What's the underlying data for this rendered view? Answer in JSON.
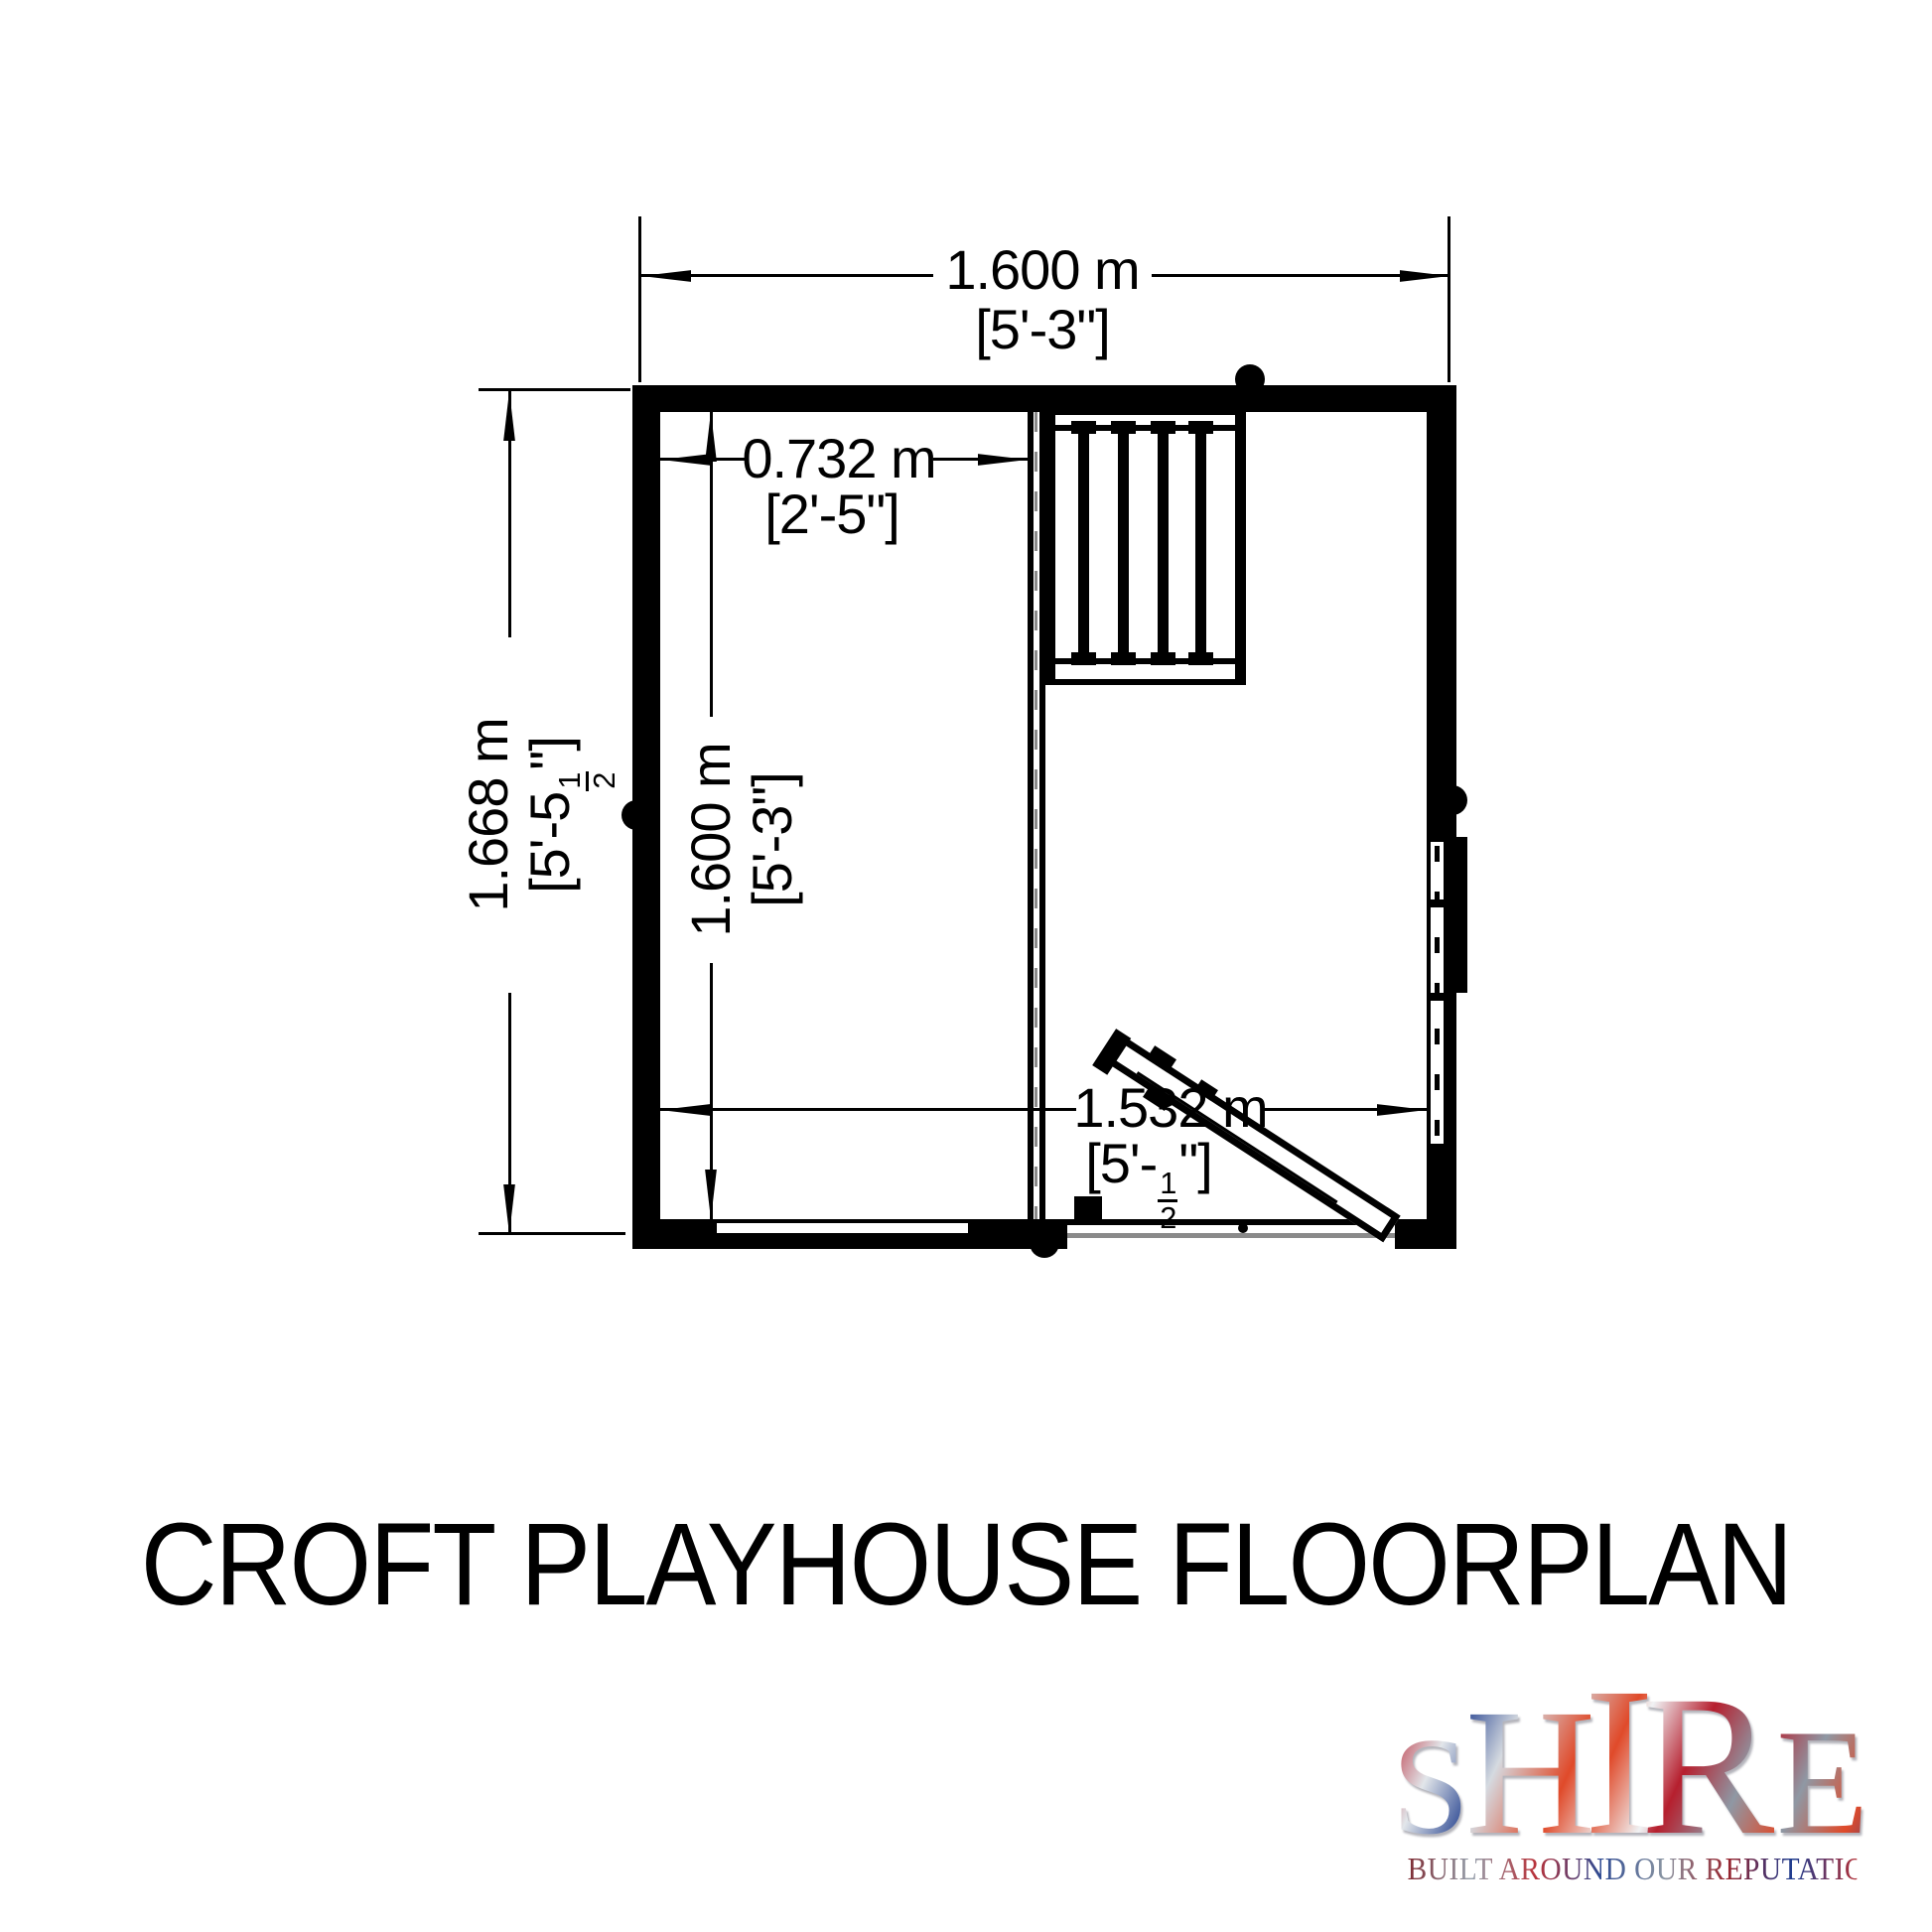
{
  "title": "CROFT PLAYHOUSE FLOORPLAN",
  "floorplan": {
    "overall_width": {
      "metric": "1.600 m",
      "imperial": "[5'-3\"]"
    },
    "overall_depth": {
      "metric": "1.668 m",
      "imperial_pre": "[5'-5",
      "imperial_frac_num": "1",
      "imperial_frac_den": "2",
      "imperial_post": "\"]"
    },
    "veranda_width": {
      "metric": "0.732 m",
      "imperial": "[2'-5\"]"
    },
    "interior_depth": {
      "metric": "1.600 m",
      "imperial": "[5'-3\"]"
    },
    "interior_width": {
      "metric": "1.532 m",
      "imperial_pre": "[5'-",
      "imperial_frac_num": "1",
      "imperial_frac_den": "2",
      "imperial_post": "\"]"
    }
  },
  "logo": {
    "letters": [
      "S",
      "H",
      "I",
      "R",
      "E"
    ],
    "tagline": "BUILT AROUND OUR REPUTATION",
    "palette": [
      "#b61f2e",
      "#24418f",
      "#e04a2a",
      "#d5dae0",
      "#8f98a4"
    ]
  }
}
